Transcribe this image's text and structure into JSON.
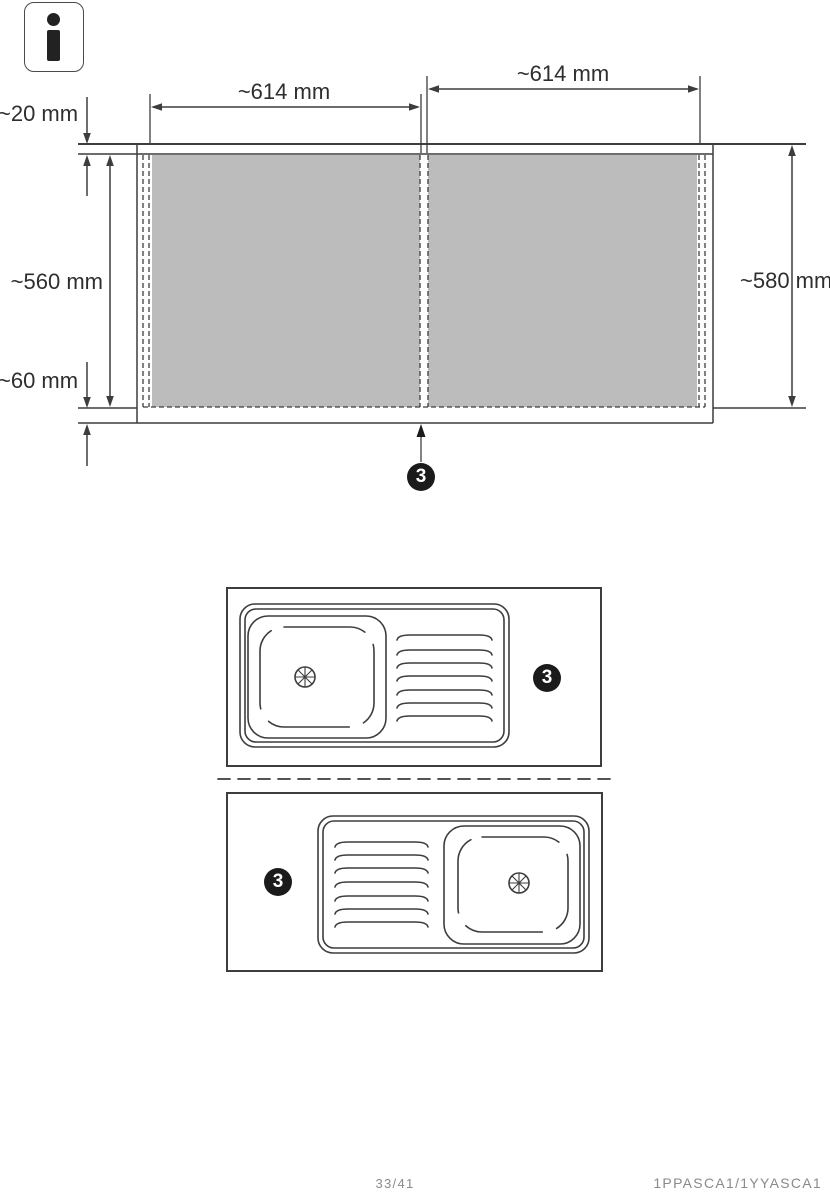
{
  "icons": [
    {
      "name": "info-icon",
      "glyph": "i"
    }
  ],
  "top_diagram": {
    "labels": {
      "width_left": "~614 mm",
      "width_right": "~614 mm",
      "countertop_thickness": "~20 mm",
      "inner_height": "~560 mm",
      "plinth_height": "~60 mm",
      "total_height": "~580 mm"
    },
    "callout": "3"
  },
  "sink_diagrams": {
    "top_callout": "3",
    "bottom_callout": "3"
  },
  "footer": {
    "page_number": "33/41",
    "document_code": "1PPASCA1/1YYASCA1"
  },
  "colors": {
    "panel_gray": "#bcbcbc",
    "line": "#3d3d3d",
    "callout_bg": "#1b1b1b",
    "footer_text": "#8a8a8a"
  }
}
